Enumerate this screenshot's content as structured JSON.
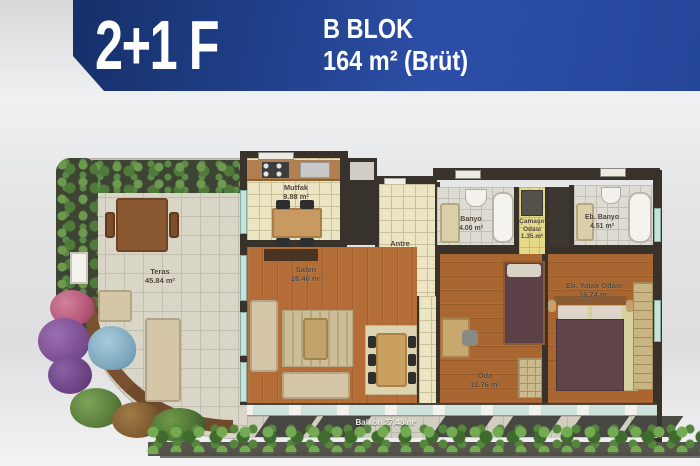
{
  "header": {
    "unit_type": "2+1 F",
    "block": "B BLOK",
    "area": "164 m² (Brüt)",
    "banner_color_left": "#12295c",
    "banner_color_right": "#2c4ea6",
    "text_color": "#ffffff"
  },
  "rooms": {
    "teras": {
      "name": "Teras",
      "area": "45.84 m²"
    },
    "mutfak": {
      "name": "Mutfak",
      "area": "9.88 m²"
    },
    "salon": {
      "name": "Salon",
      "area": "26.46 m²"
    },
    "antre": {
      "name": "Antre",
      "area": "9.98 m²"
    },
    "banyo": {
      "name": "Banyo",
      "area": "4.00 m²"
    },
    "camasir": {
      "name": "Çamaşır Odası",
      "area": "1.35 m²"
    },
    "eb_banyo": {
      "name": "Eb. Banyo",
      "area": "4.51 m²"
    },
    "eb_yatak": {
      "name": "Eb. Yatak Odası",
      "area": "16.74 m²"
    },
    "oda": {
      "name": "Oda",
      "area": "12.76 m²"
    },
    "balkon": {
      "name": "Balkon",
      "area": "27.48 m²"
    }
  },
  "plan_colors": {
    "wall": "#39322a",
    "wood_floor": "#b46d36",
    "cream_tile": "#ebe5c4",
    "bath_tile": "#dedbd2",
    "hedge_green": "#5b8a44",
    "pond_blue": "#7fa9bf"
  }
}
